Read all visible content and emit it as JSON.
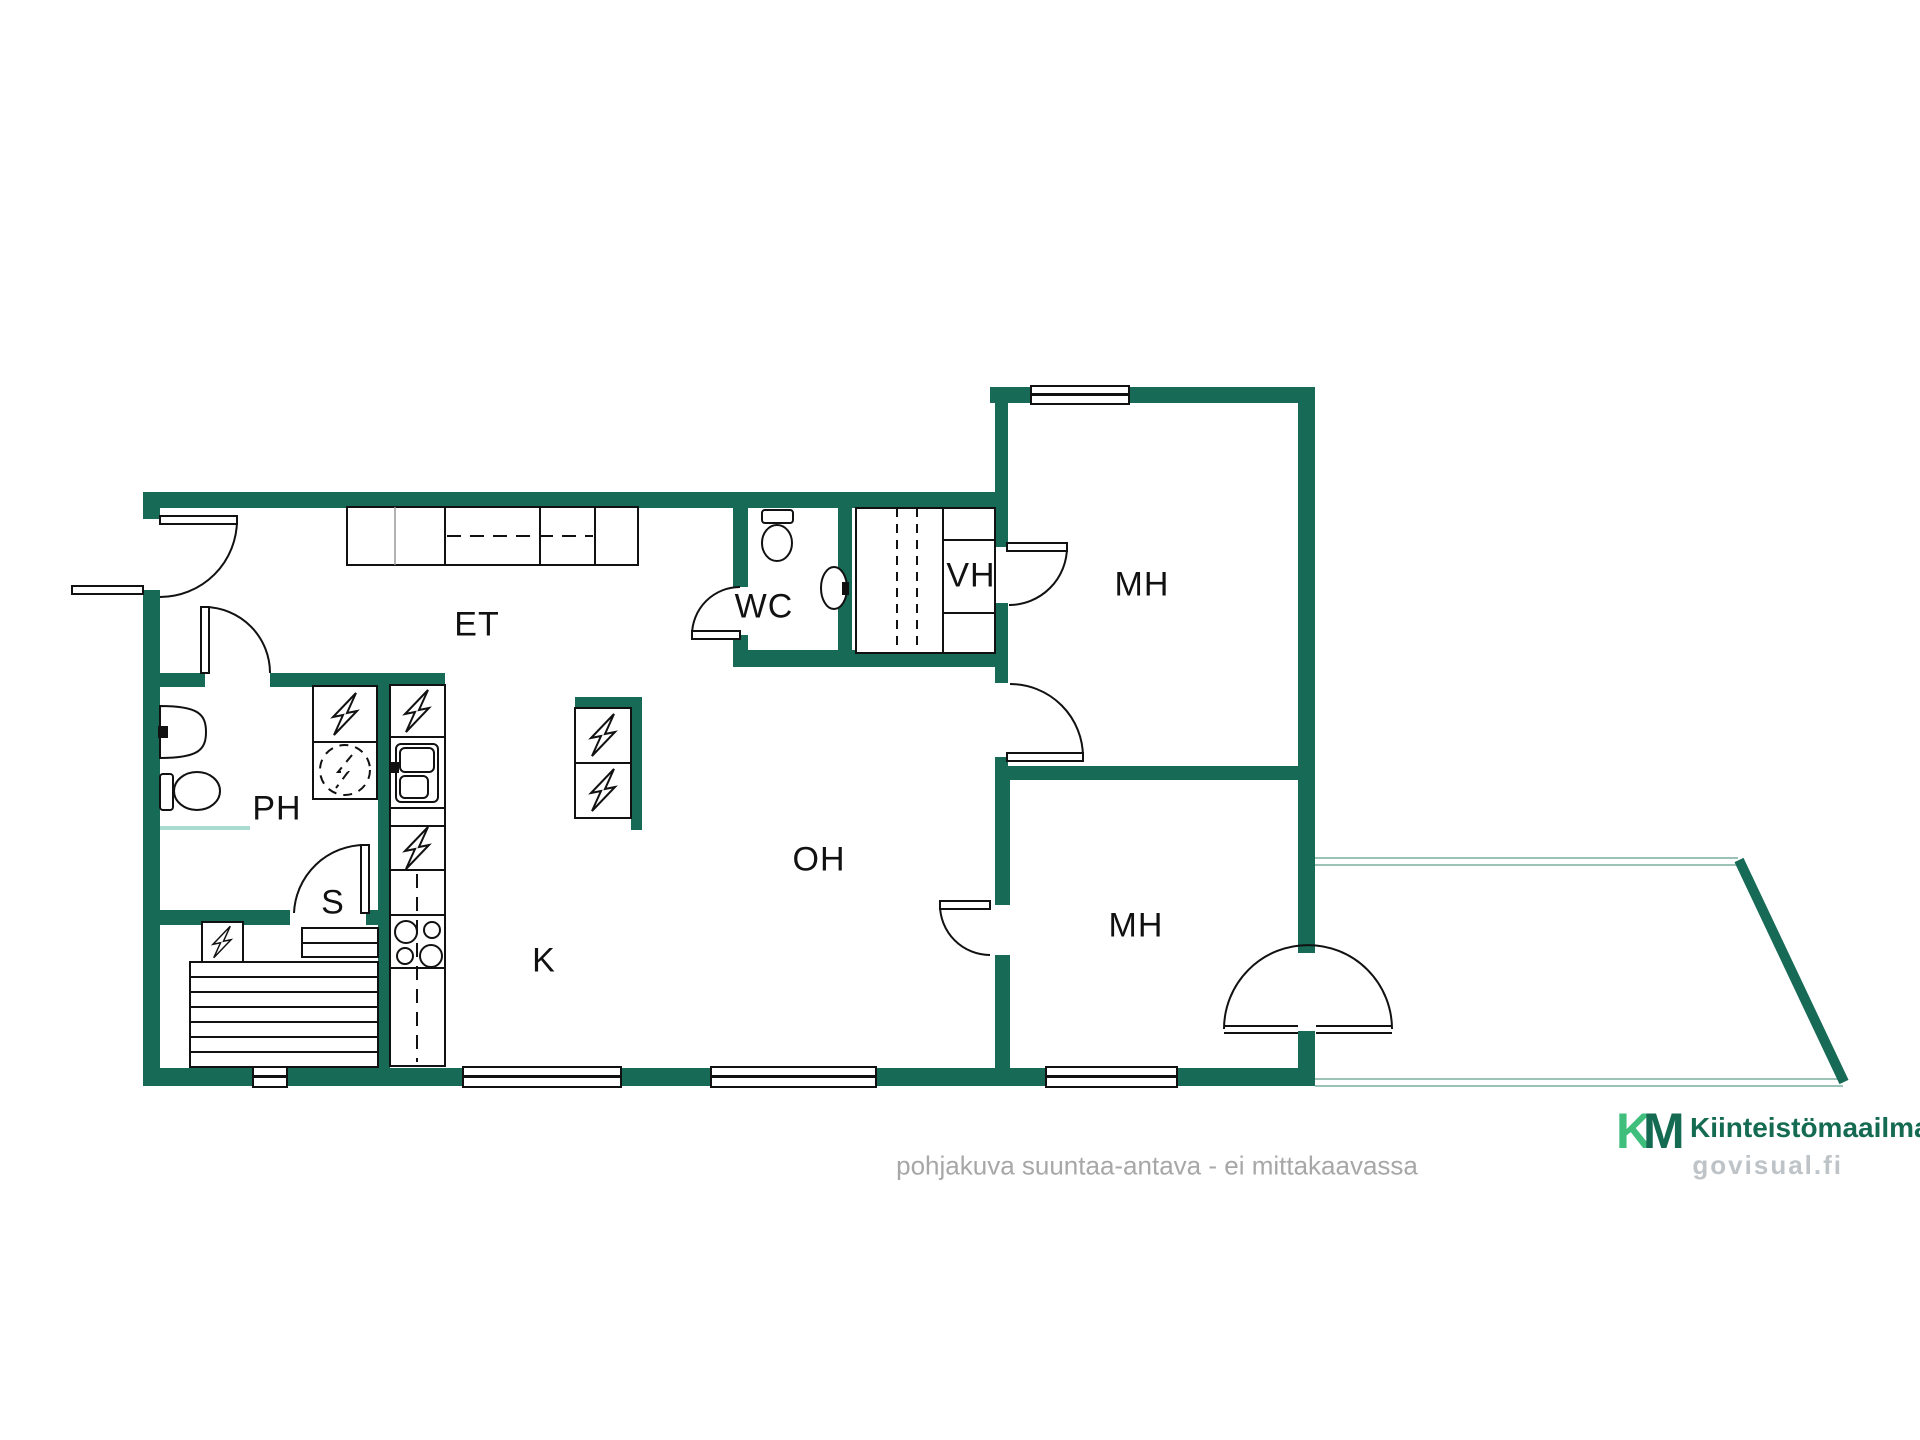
{
  "rooms": {
    "et": {
      "label": "ET"
    },
    "wc": {
      "label": "WC"
    },
    "vh": {
      "label": "VH"
    },
    "mh1": {
      "label": "MH"
    },
    "mh2": {
      "label": "MH"
    },
    "ph": {
      "label": "PH"
    },
    "s": {
      "label": "S"
    },
    "k": {
      "label": "K"
    },
    "oh": {
      "label": "OH"
    }
  },
  "footer": {
    "disclaimer": "pohjakuva suuntaa-antava - ei mittakaavassa"
  },
  "branding": {
    "mark_k": "K",
    "mark_m": "M",
    "name": "Kiinteistömaailma",
    "site": "govisual.fi"
  },
  "colors": {
    "wall": "#166A56",
    "line": "#111111",
    "brand_dark": "#156A52",
    "brand_light": "#3FBE7C",
    "muted_text": "#A7A7A7",
    "site_text": "#BDC3C7",
    "terrace_line": "#9CC2B8",
    "shower_line": "#AADBD0"
  }
}
